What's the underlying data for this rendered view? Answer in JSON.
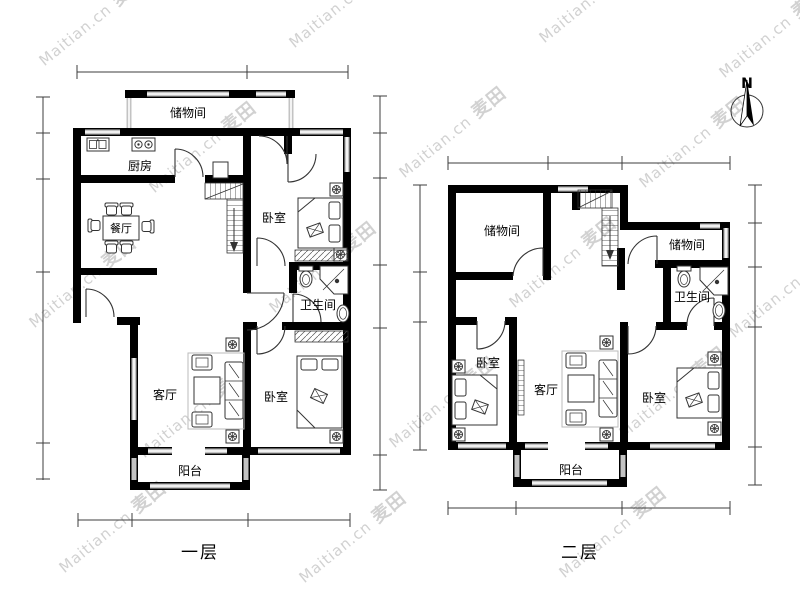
{
  "watermark": {
    "en": "Maitian.cn",
    "zh": "麦田"
  },
  "compass": {
    "label": "N"
  },
  "floor1": {
    "label": "一层",
    "rooms": {
      "storage": "储物间",
      "kitchen": "厨房",
      "dining": "餐厅",
      "bedroom_top": "卧室",
      "bathroom": "卫生间",
      "living": "客厅",
      "bedroom_bottom": "卧室",
      "balcony": "阳台"
    }
  },
  "floor2": {
    "label": "二层",
    "rooms": {
      "storage_left": "储物间",
      "storage_right": "储物间",
      "bathroom": "卫生间",
      "bedroom_left": "卧室",
      "living": "客厅",
      "bedroom_right": "卧室",
      "balcony": "阳台"
    }
  },
  "colors": {
    "wall": "#000000",
    "window": "#c3c3c3",
    "dimension": "#3c3c3c",
    "watermark": "#c6c6c6",
    "background": "#ffffff"
  }
}
